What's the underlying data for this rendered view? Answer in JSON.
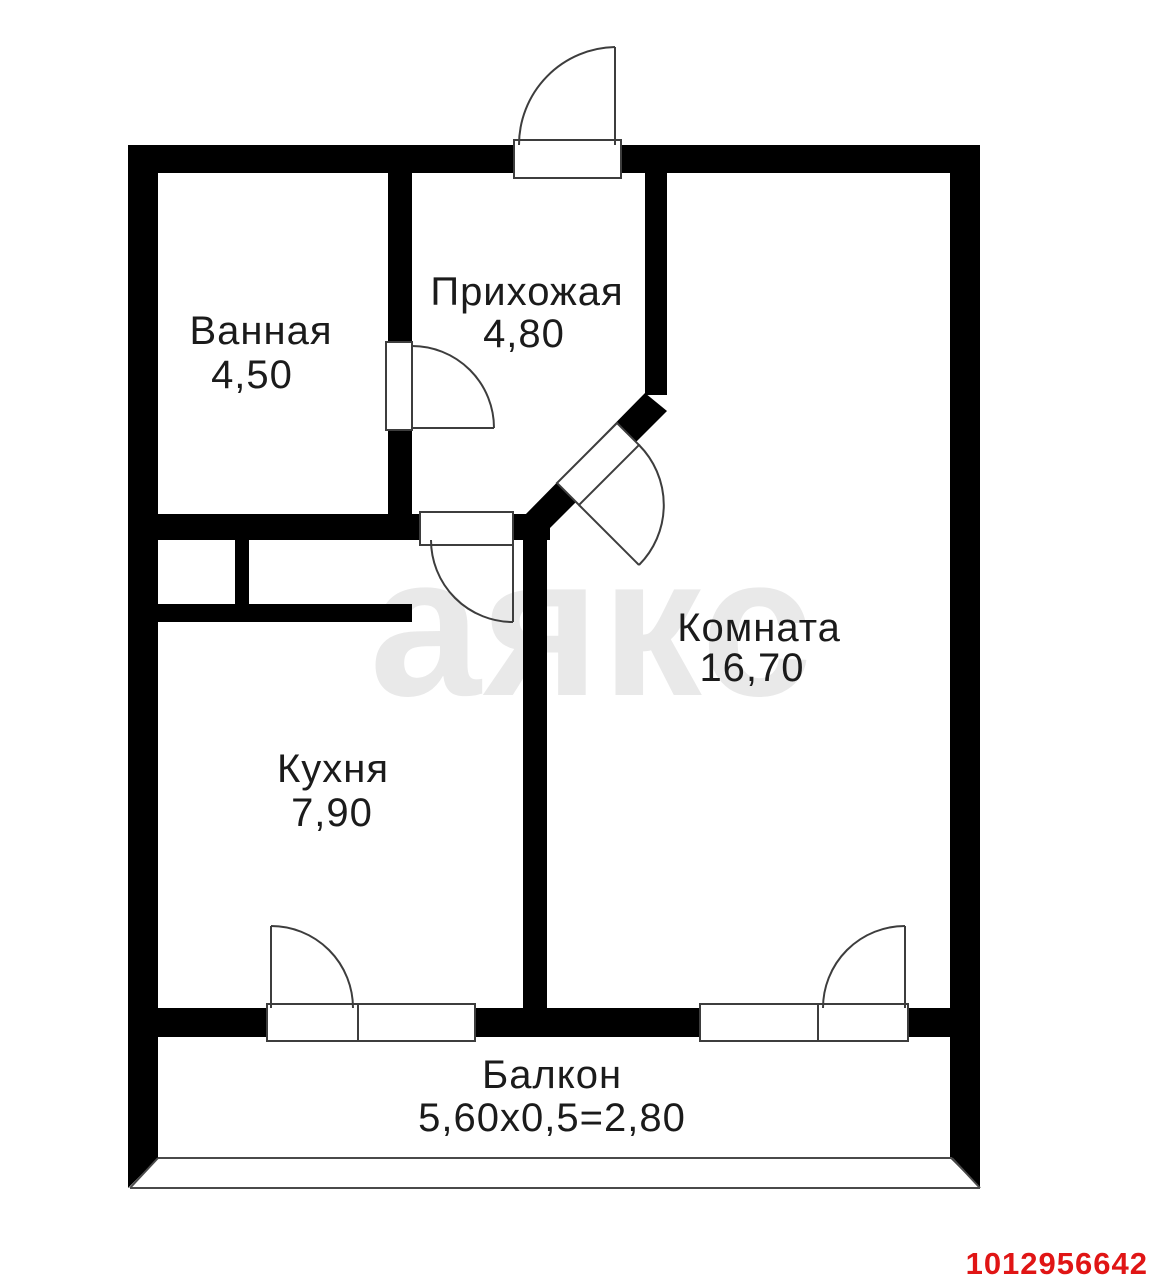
{
  "watermark": "аякс",
  "listing_id": "1012956642",
  "rooms": [
    {
      "name": "Ванная",
      "area": "4,50"
    },
    {
      "name": "Прихожая",
      "area": "4,80"
    },
    {
      "name": "Комната",
      "area": "16,70"
    },
    {
      "name": "Кухня",
      "area": "7,90"
    },
    {
      "name": "Балкон",
      "area": "5,60х0,5=2,80"
    }
  ],
  "colors": {
    "walls": "#000000",
    "watermark": "#e9e9e9",
    "label": "#1b1b1b",
    "listing_id": "#e01515",
    "background": "#ffffff"
  }
}
